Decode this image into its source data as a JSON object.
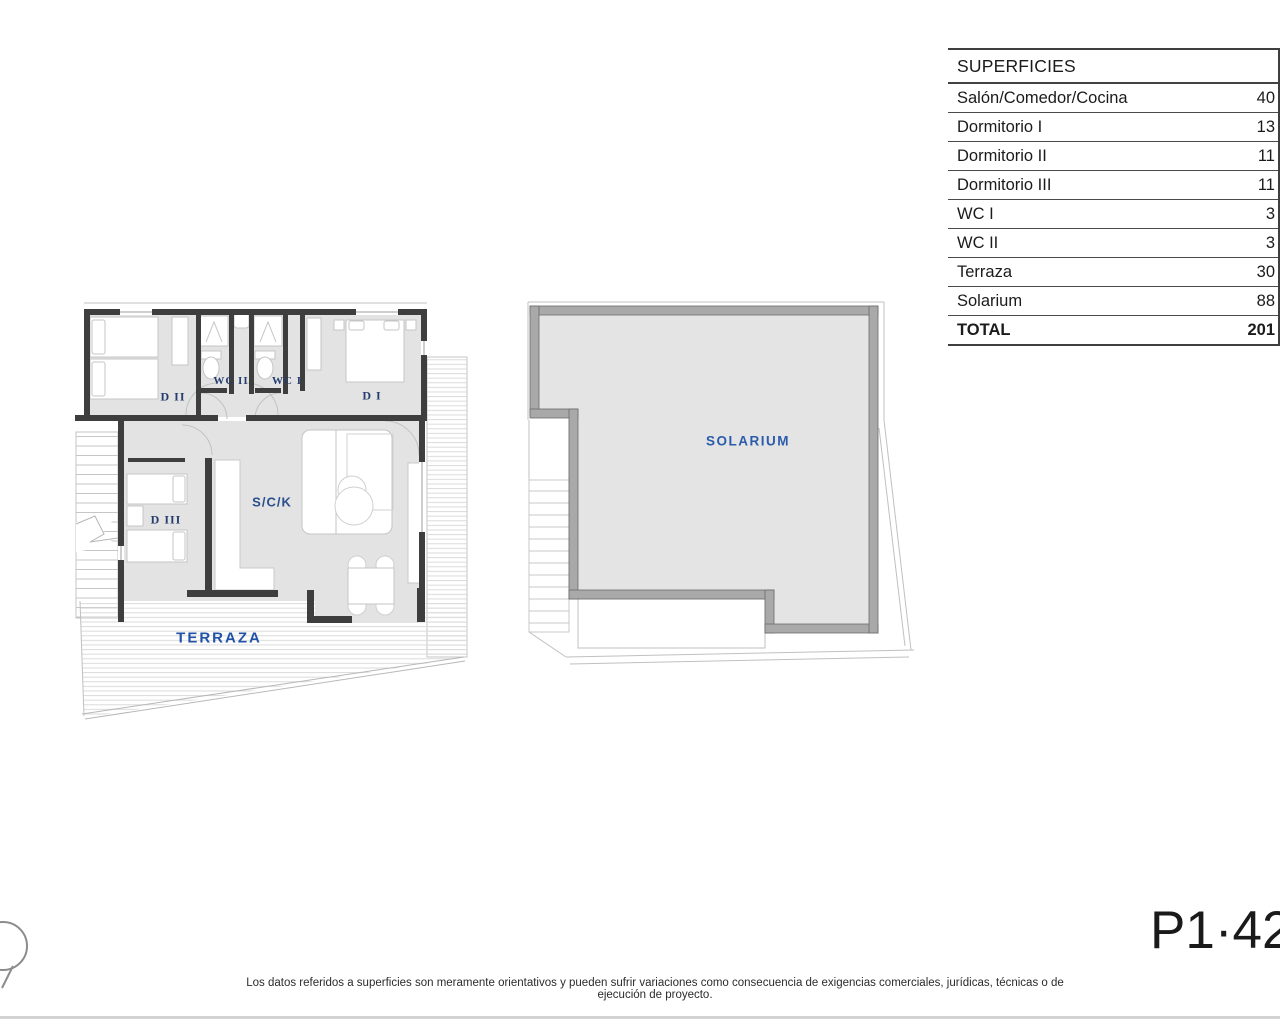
{
  "page": {
    "plan_code": "P1·42",
    "disclaimer": "Los datos referidos a superficies son meramente orientativos y pueden sufrir variaciones como consecuencia de exigencias comerciales, jurídicas, técnicas o de ejecución de proyecto."
  },
  "superficies": {
    "title": "SUPERFICIES",
    "rows": [
      {
        "label": "Salón/Comedor/Cocina",
        "value": "40",
        "bold": false
      },
      {
        "label": "Dormitorio I",
        "value": "13",
        "bold": false
      },
      {
        "label": "Dormitorio II",
        "value": "11",
        "bold": false
      },
      {
        "label": "Dormitorio III",
        "value": "11",
        "bold": false
      },
      {
        "label": "WC I",
        "value": "3",
        "bold": false
      },
      {
        "label": "WC II",
        "value": "3",
        "bold": false
      },
      {
        "label": "Terraza",
        "value": "30",
        "bold": false
      },
      {
        "label": "Solarium",
        "value": "88",
        "bold": false
      },
      {
        "label": "TOTAL",
        "value": "201",
        "bold": true
      }
    ]
  },
  "floor_plan": {
    "rooms": {
      "d2": "D II",
      "wc2": "WC II",
      "wc1": "WC I",
      "d1": "D I",
      "d3": "D III",
      "sck": "S/C/K",
      "terraza": "TERRAZA"
    }
  },
  "solarium_plan": {
    "label": "SOLARIUM"
  },
  "colors": {
    "floor_fill": "#e3e3e3",
    "wall": "#3e3e3e",
    "room_label": "#253d6e",
    "area_label": "#2b5cab",
    "table_line": "#4a4a4a",
    "hatch_line": "#dcdcdc"
  }
}
